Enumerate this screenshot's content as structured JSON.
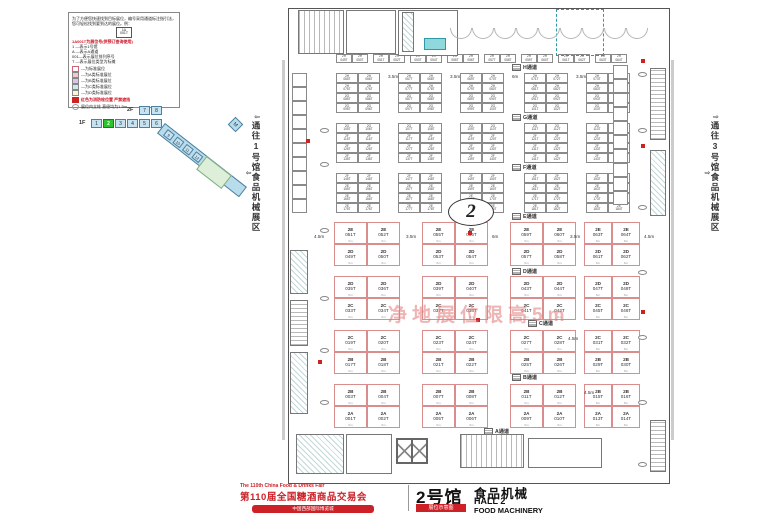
{
  "legend": {
    "intro": "为了方便您快速找到目标展位，编号采用通道标注指引法，您可轻松找到要到达的展位。例：",
    "example_booth": {
      "line1": "1A",
      "line2": "001T"
    },
    "subtitle": "1A001T为展位号(供预订查询使用)",
    "rules": [
      "1 —表示1号馆",
      "A —表示A通道",
      "001—表示展位排列序号",
      "T —表示展位类型为标摊"
    ],
    "classes": [
      {
        "fill": "#ffffff",
        "border": "#cc6677",
        "label": "—为标准展位"
      },
      {
        "fill": "#f6c6d0",
        "border": "#888888",
        "label": "—为A类标准展位"
      },
      {
        "fill": "#d8c6e8",
        "border": "#888888",
        "label": "—为B类标准展位"
      },
      {
        "fill": "#cce9f2",
        "border": "#888888",
        "label": "—为C类标准展位"
      },
      {
        "fill": "#fdf6d0",
        "border": "#888888",
        "label": "—为D类标准展位"
      }
    ],
    "fire_note": "红色为消防栓位置 严禁遮挡",
    "column_note": "展位内立柱 直径均为1.5m"
  },
  "floors": {
    "f2_label": "2F",
    "f2_halls": [
      "7",
      "8"
    ],
    "f1_label": "1F",
    "f1_halls": [
      "1",
      "2",
      "3",
      "4",
      "5",
      "6"
    ],
    "active_hall": "2",
    "wing_halls": [
      "9",
      "10",
      "11",
      "12",
      "13"
    ],
    "metro": "M"
  },
  "corridors": {
    "left": "通往1号馆食品机械展区",
    "right": "通往3号馆食品机械展区",
    "arrow_left": "⇦",
    "arrow_right": "⇨"
  },
  "hall": {
    "number_badge": "2",
    "watermark": "净地展位限高5m",
    "aisles": [
      "H通道",
      "G通道",
      "F通道",
      "E通道",
      "D通道",
      "C通道",
      "B通道",
      "A通道"
    ],
    "dims_upper": [
      "3.5m",
      "3.5m",
      "6m",
      "3.5m"
    ],
    "dims_lower": [
      "4.5m",
      "3.5m",
      "6m",
      "3.5m",
      "4.5m"
    ],
    "stray_dims": [
      "4.5m",
      "4.5m"
    ],
    "booth_dim": "6m",
    "upper_top_row": {
      "prefix": "2H",
      "start": 49,
      "count": 16
    },
    "upper_blocks": [
      {
        "rows": [
          {
            "prefix": "2H",
            "start": 65
          },
          {
            "prefix": "2H",
            "start": 75
          },
          {
            "prefix": "2G",
            "start": 85
          },
          {
            "prefix": "2G",
            "start": 95
          }
        ]
      },
      {
        "rows": [
          {
            "prefix": "2G",
            "start": 105
          },
          {
            "prefix": "2F",
            "start": 115
          },
          {
            "prefix": "2F",
            "start": 125
          },
          {
            "prefix": "2F",
            "start": 135
          }
        ]
      },
      {
        "rows": [
          {
            "prefix": "2F",
            "start": 145
          },
          {
            "prefix": "2E",
            "start": 155
          },
          {
            "prefix": "2E",
            "start": 165
          },
          {
            "prefix": "2E",
            "start": 175
          }
        ]
      }
    ],
    "lower_blocks": [
      {
        "rows": [
          [
            "2E 051T",
            "2E 052T",
            "2E 055T",
            "2E 056T",
            "2E 059T",
            "2E 060T",
            "2E 063T",
            "2E 064T"
          ],
          [
            "2D 049T",
            "2D 050T",
            "2D 053T",
            "2D 054T",
            "2D 057T",
            "2D 058T",
            "2D 061T",
            "2D 062T"
          ]
        ]
      },
      {
        "rows": [
          [
            "2D 035T",
            "2D 036T",
            "2D 039T",
            "2D 040T",
            "2D 043T",
            "2D 044T",
            "2D 047T",
            "2D 048T"
          ],
          [
            "2C 033T",
            "2C 034T",
            "2C 037T",
            "2C 038T",
            "2C 041T",
            "2C 042T",
            "2C 045T",
            "2C 046T"
          ]
        ]
      },
      {
        "rows": [
          [
            "2C 019T",
            "2C 020T",
            "2C 023T",
            "2C 024T",
            "2C 027T",
            "2C 028T",
            "2C 031T",
            "2C 032T"
          ],
          [
            "2B 017T",
            "2B 018T",
            "2B 021T",
            "2B 022T",
            "2B 025T",
            "2B 026T",
            "2B 029T",
            "2B 030T"
          ]
        ]
      },
      {
        "rows": [
          [
            "2B 003T",
            "2B 004T",
            "2B 007T",
            "2B 008T",
            "2B 011T",
            "2B 012T",
            "2B 015T",
            "2B 016T"
          ],
          [
            "2A 001T",
            "2A 002T",
            "2A 005T",
            "2A 006T",
            "2A 009T",
            "2A 010T",
            "2A 013T",
            "2A 014T"
          ]
        ]
      }
    ]
  },
  "footer": {
    "fair_en": "The 110th China Food & Drinks Fair",
    "fair_cn": "第110届全国糖酒商品交易会",
    "venue_bar": "中国西部国际博览城",
    "hall_cn": "2号馆",
    "badge": "展位示意图",
    "category_cn": "食品机械",
    "hall_en": "HALL 2",
    "category_en": "FOOD MACHINERY"
  }
}
